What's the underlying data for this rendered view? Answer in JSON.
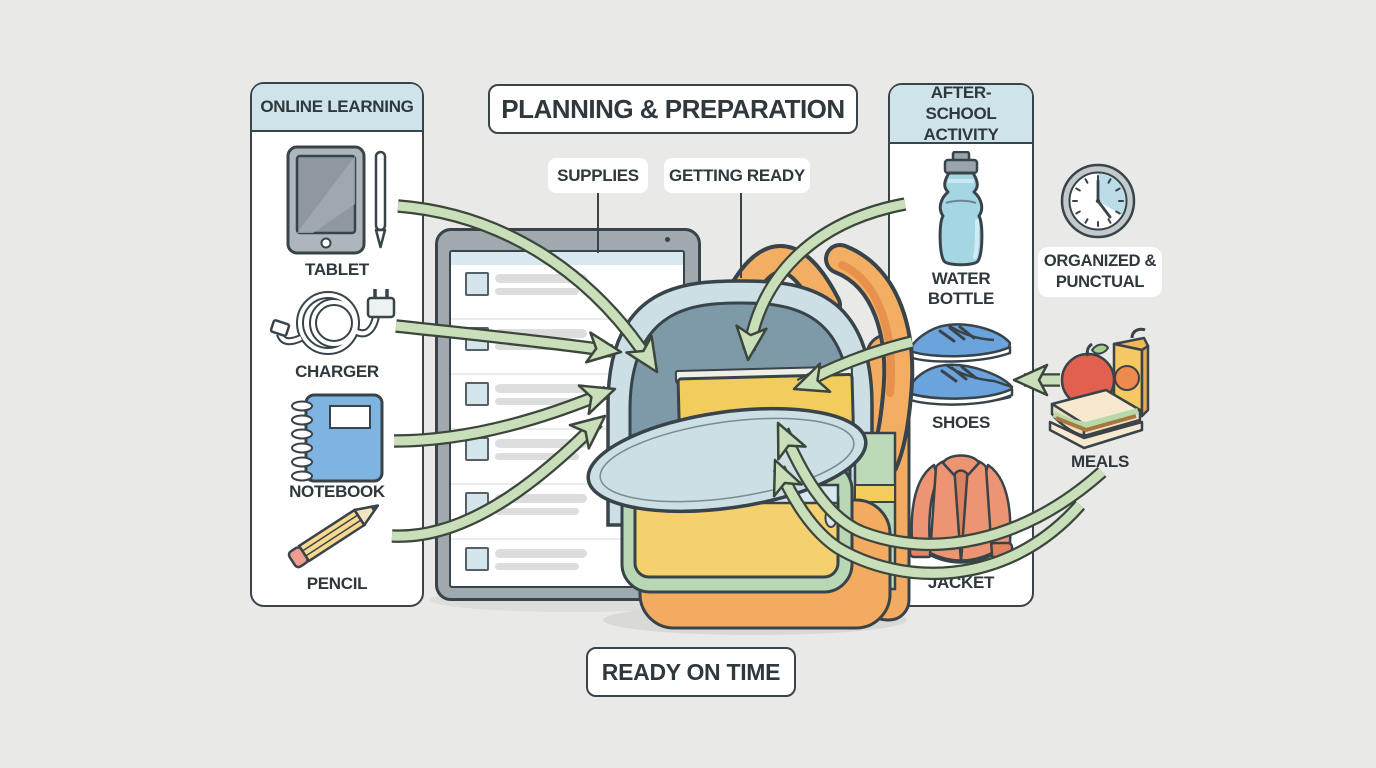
{
  "title": "PLANNING & PREPARATION",
  "connector_labels": {
    "supplies": "SUPPLIES",
    "getting_ready": "GETTING READY"
  },
  "footer_label": "READY ON TIME",
  "left_panel": {
    "header": "ONLINE LEARNING",
    "items": [
      {
        "label": "TABLET",
        "icon": "tablet-icon"
      },
      {
        "label": "CHARGER",
        "icon": "charger-icon"
      },
      {
        "label": "NOTEBOOK",
        "icon": "notebook-icon"
      },
      {
        "label": "PENCIL",
        "icon": "pencil-icon"
      }
    ]
  },
  "right_panel": {
    "header": "AFTER-SCHOOL ACTIVITY",
    "items": [
      {
        "label": "WATER BOTTLE",
        "icon": "water-bottle-icon"
      },
      {
        "label": "SHOES",
        "icon": "shoes-icon"
      },
      {
        "label": "JACKET",
        "icon": "jacket-icon"
      }
    ]
  },
  "annotations": {
    "clock_label": "ORGANIZED & PUNCTUAL",
    "meals_label": "MEALS"
  },
  "checklist": {
    "row_count": 6
  },
  "colors": {
    "background": "#e9e9e7",
    "panel_header_blue": "#cfe4ea",
    "outline_dark": "#39434a",
    "arrow_green_fill": "#c8dfba",
    "arrow_green_outline": "#3c463c",
    "backpack_flap_blue": "#cbdfe4",
    "backpack_body_slate": "#7e99a7",
    "backpack_orange": "#f2ab60",
    "pocket_yellow": "#f5d06e",
    "book_yellow": "#f2cd5e",
    "pocket_green": "#b9d7b4",
    "device_gray": "#a0a9ae",
    "checkbox_blue": "#d4e6ec",
    "water_blue": "#a5d6e4",
    "shoe_blue": "#6ba3dc",
    "jacket_orange": "#ed9472",
    "notebook_blue": "#7fb3e0",
    "pencil_yellow": "#f7d98f",
    "apple_red": "#e2604f",
    "juice_yellow": "#f6c863"
  }
}
